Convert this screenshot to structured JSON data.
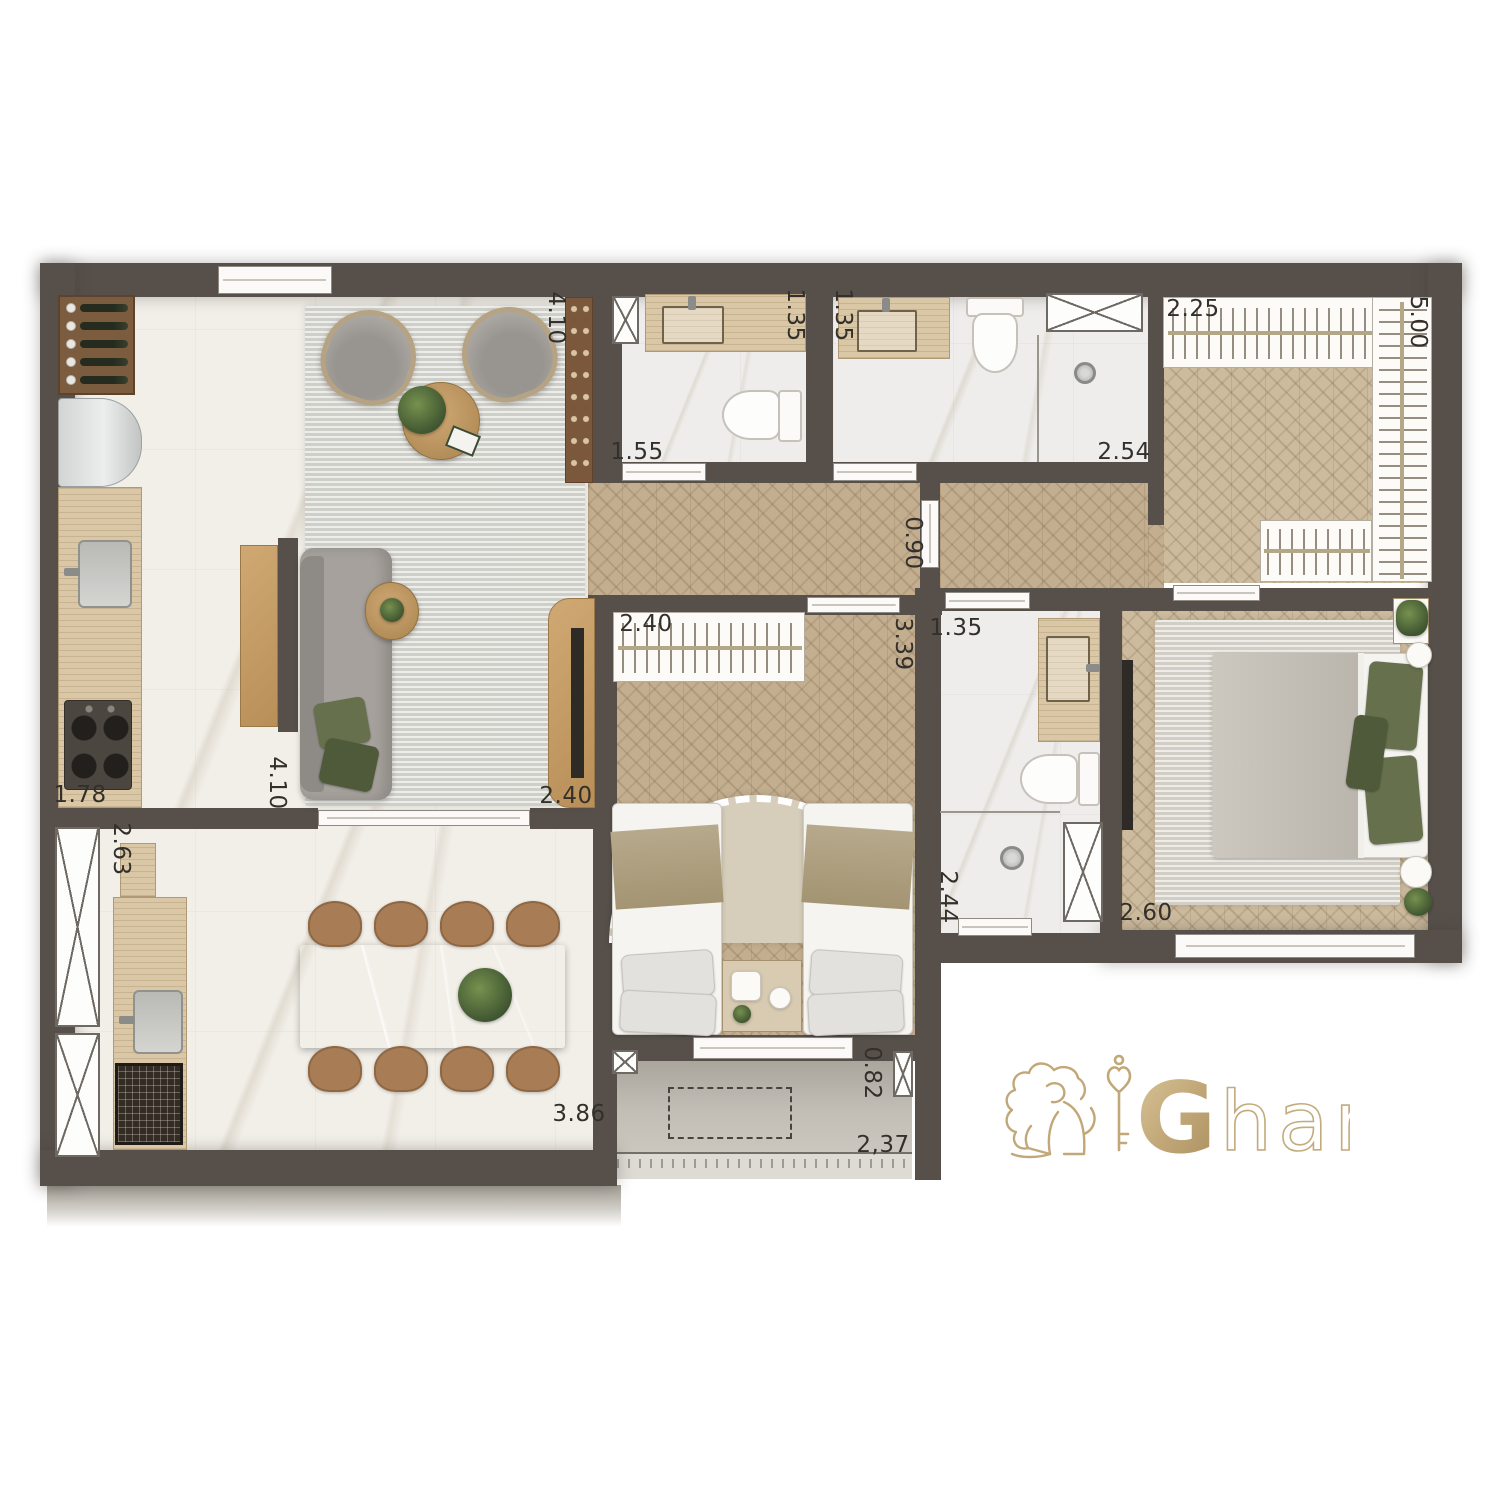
{
  "plan": {
    "type": "apartment-floor-plan",
    "colors": {
      "wall": "#57504a",
      "wood_floor": "#c3ae8f",
      "marble_floor": "#f2efe9",
      "travertine_counter": "#d9c7a6",
      "logo_gold": "#c2a878",
      "accent_green": "#66704c"
    }
  },
  "dimensions": [
    {
      "id": "living-top",
      "value": "4.10"
    },
    {
      "id": "bath1-width",
      "value": "1.35"
    },
    {
      "id": "bath2-width",
      "value": "1.35"
    },
    {
      "id": "closet-width",
      "value": "2.25"
    },
    {
      "id": "closet-length",
      "value": "5.00"
    },
    {
      "id": "bath1-length",
      "value": "1.55"
    },
    {
      "id": "bath2-length",
      "value": "2.54"
    },
    {
      "id": "hall-door",
      "value": "0.90"
    },
    {
      "id": "bedroom2-closet",
      "value": "2.40"
    },
    {
      "id": "bedroom2-depth",
      "value": "3.39"
    },
    {
      "id": "bath3-width",
      "value": "1.35"
    },
    {
      "id": "kitchen-counter",
      "value": "1.78"
    },
    {
      "id": "living-side",
      "value": "4.10"
    },
    {
      "id": "living-width",
      "value": "2.40"
    },
    {
      "id": "dining-counter",
      "value": "2.63"
    },
    {
      "id": "bath3-depth",
      "value": "2.44"
    },
    {
      "id": "master-width",
      "value": "2.60"
    },
    {
      "id": "dining-length",
      "value": "3.86"
    },
    {
      "id": "balcony-depth",
      "value": "0.82"
    },
    {
      "id": "balcony-width",
      "value": "2,37"
    }
  ],
  "logo": {
    "initial": "G",
    "rest": "har"
  }
}
